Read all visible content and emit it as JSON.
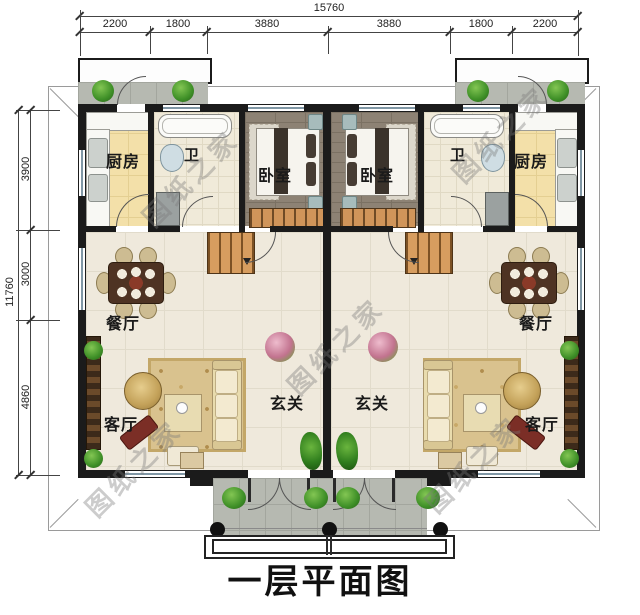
{
  "title": "一层平面图",
  "watermark_text": "图纸之家",
  "dimensions": {
    "top": {
      "total": "15760",
      "segments": [
        "2200",
        "1800",
        "3880",
        "3880",
        "1800",
        "2200"
      ]
    },
    "left": {
      "total": "11760",
      "segments": [
        "3900",
        "3000",
        "4860"
      ]
    }
  },
  "room_labels": {
    "kitchen": "厨房",
    "bath": "卫",
    "bedroom": "卧室",
    "dining": "餐厅",
    "living": "客厅",
    "foyer": "玄关"
  },
  "colors": {
    "wall": "#1b1b1b",
    "kitchen_floor": "#f3e0a9",
    "bedroom_floor": "#8d8274",
    "hall_floor": "#efe9dc",
    "stair_wood": "#d79d5f",
    "window_glass": "#8097a5",
    "porch_floor": "#b6b9b1"
  }
}
